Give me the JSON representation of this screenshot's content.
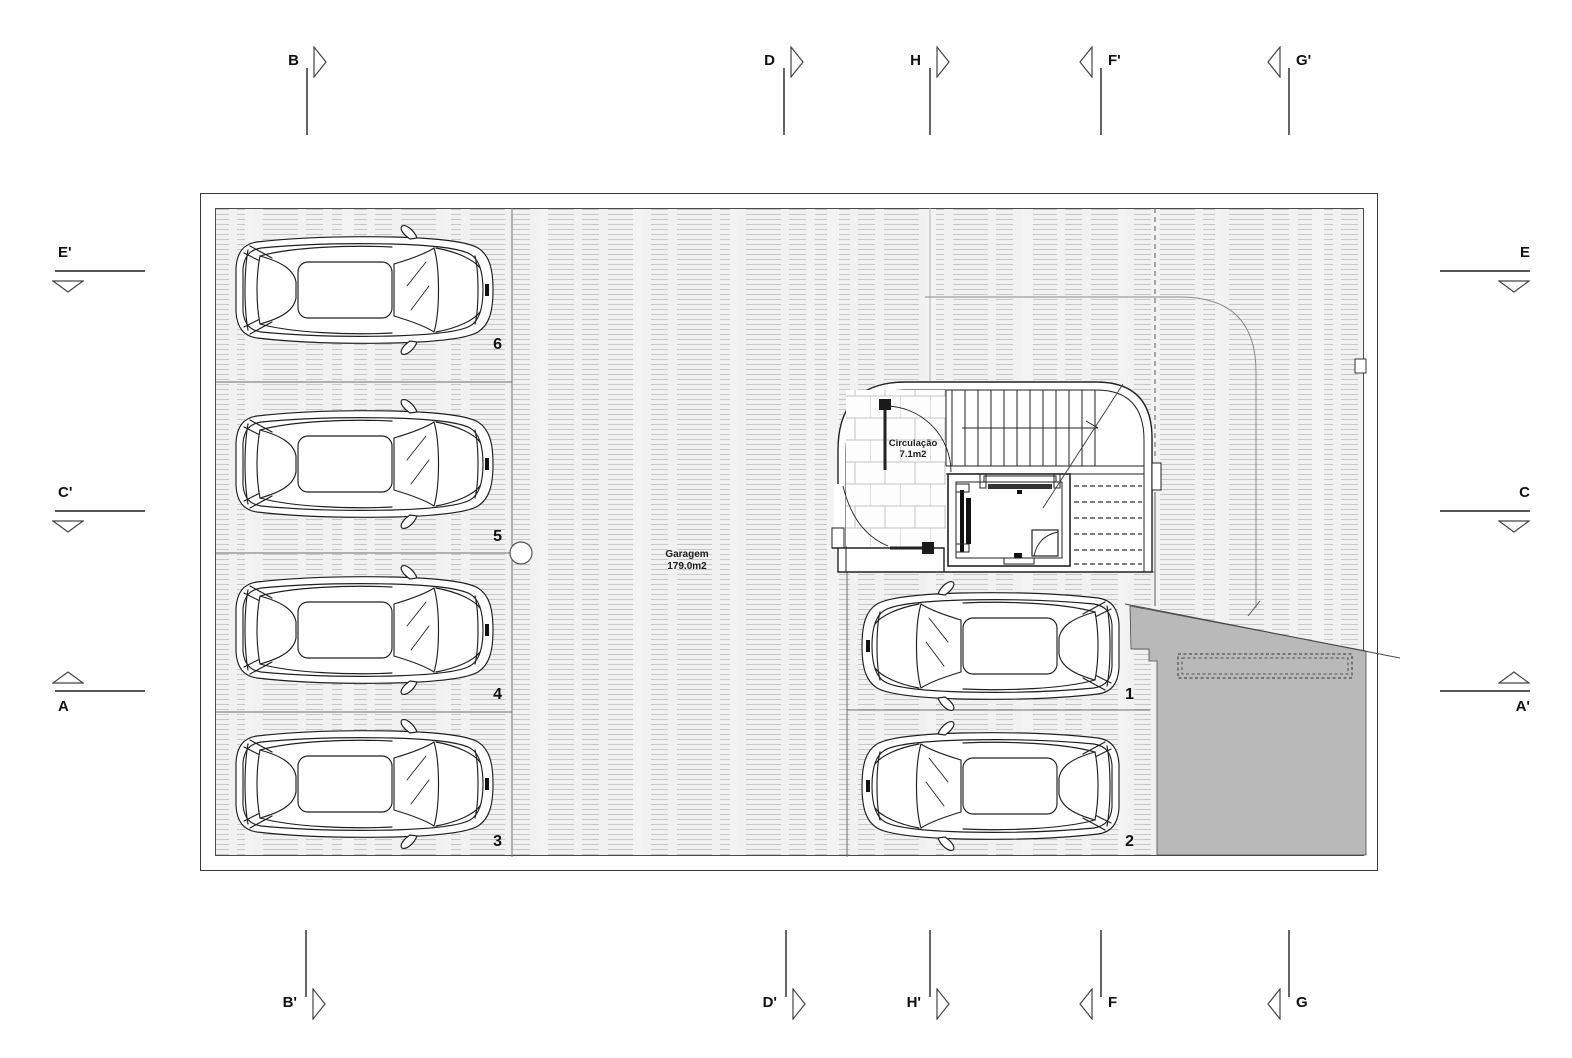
{
  "rooms": {
    "garage": {
      "name": "Garagem",
      "area": "179.0m2"
    },
    "circulation": {
      "name": "Circulação",
      "area": "7.1m2"
    }
  },
  "stalls": [
    {
      "number": "6"
    },
    {
      "number": "5"
    },
    {
      "number": "4"
    },
    {
      "number": "3"
    },
    {
      "number": "1"
    },
    {
      "number": "2"
    }
  ],
  "sections": {
    "top": [
      {
        "label": "B"
      },
      {
        "label": "D"
      },
      {
        "label": "H"
      },
      {
        "label": "F'"
      },
      {
        "label": "G'"
      }
    ],
    "bottom": [
      {
        "label": "B'"
      },
      {
        "label": "D'"
      },
      {
        "label": "H'"
      },
      {
        "label": "F"
      },
      {
        "label": "G"
      }
    ],
    "left": [
      {
        "label": "E'"
      },
      {
        "label": "C'"
      },
      {
        "label": "A"
      }
    ],
    "right": [
      {
        "label": "E"
      },
      {
        "label": "C"
      },
      {
        "label": "A'"
      }
    ]
  },
  "colors": {
    "ramp_gray": "#b9b9b9",
    "line_dark": "#222222",
    "floor_line": "#c7c7c7"
  }
}
